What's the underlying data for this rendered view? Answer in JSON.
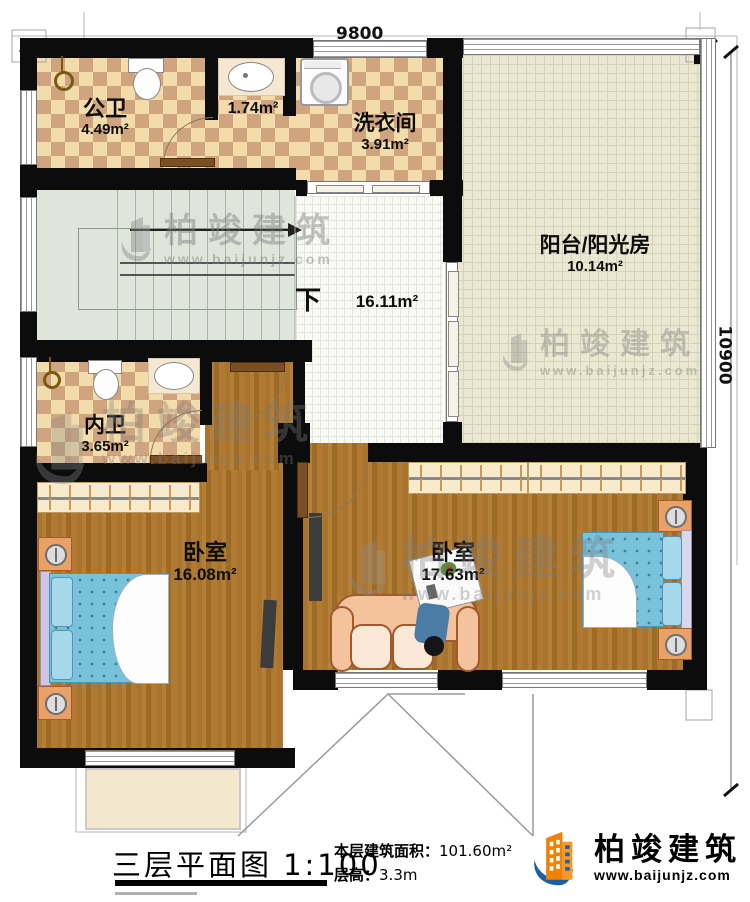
{
  "dimensions": {
    "top": "9800",
    "right": "10900"
  },
  "rooms": [
    {
      "name": "公卫",
      "area": "4.49m²"
    },
    {
      "name": "",
      "area": "1.74m²"
    },
    {
      "name": "洗衣间",
      "area": "3.91m²"
    },
    {
      "name": "阳台/阳光房",
      "area": "10.14m²"
    },
    {
      "name": "",
      "area": "16.11m²"
    },
    {
      "name": "内卫",
      "area": "3.65m²"
    },
    {
      "name": "卧室",
      "area": "16.08m²"
    },
    {
      "name": "卧室",
      "area": "17.63m²"
    }
  ],
  "stairs": {
    "down_label": "下"
  },
  "footer": {
    "plan_title": "三层平面图",
    "scale": "1:100",
    "area_label": "本层建筑面积：",
    "area_value": "101.60m²",
    "height_label": "层高：",
    "height_value": "3.3m"
  },
  "brand": {
    "name": "柏竣建筑",
    "url": "www.baijunjz.com"
  },
  "colors": {
    "wall": "#0c0c0c",
    "tile_light": "#f3dcab",
    "tile_dark": "#cfa47f",
    "wood": "#a9742e",
    "stair_floor": "#dfe5db",
    "hall_floor": "#f9f9f6",
    "balcony_floor": "#eae8d2",
    "bed": "#79c2dc",
    "logo_orange": "#ef8200",
    "logo_blue": "#1b5fa8"
  },
  "furniture_icons": [
    "toilet-icon",
    "sink-icon",
    "washing-machine-icon",
    "wardrobe-icon",
    "double-bed-icon",
    "nightstand-icon",
    "sofa-icon",
    "tv-icon",
    "coffee-table-icon",
    "towel-ring-icon"
  ]
}
